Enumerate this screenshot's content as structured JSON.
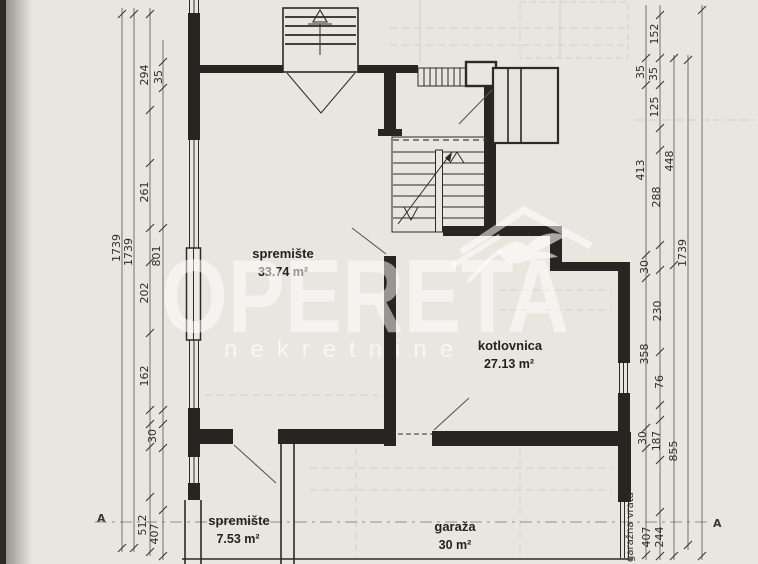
{
  "document": {
    "type_hint": "scanned floor plan",
    "colors": {
      "paper": "#e9e6df",
      "ink": "#262522",
      "watermark": "#ffffff",
      "edge_shadow": "#2b2a27"
    }
  },
  "plan": {
    "rooms": {
      "storage_main": {
        "name": "spremište",
        "area": "33.74 m²"
      },
      "boiler": {
        "name": "kotlovnica",
        "area": "27.13 m²"
      },
      "storage_small": {
        "name": "spremište",
        "area": "7.53 m²"
      },
      "garage": {
        "name": "garaža",
        "area": "30 m²"
      }
    },
    "annotations": {
      "garage_door": "garažna vrata",
      "section_a_left": "A",
      "section_a_right": "A"
    },
    "dims_left": [
      "1739",
      "1739",
      "294",
      "35",
      "261",
      "801",
      "202",
      "162",
      "30",
      "512",
      "407"
    ],
    "dims_right": [
      "152",
      "35",
      "35",
      "125",
      "448",
      "413",
      "288",
      "30",
      "1739",
      "230",
      "358",
      "76",
      "30",
      "187",
      "855",
      "407",
      "244"
    ]
  },
  "watermark": {
    "brand": "OPERETA",
    "subtitle": "nekretnine"
  }
}
